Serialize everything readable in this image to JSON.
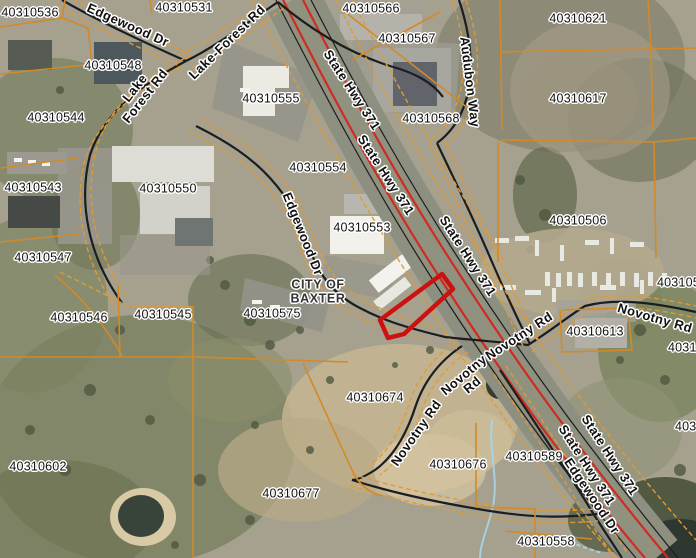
{
  "map": {
    "city_label": {
      "line1": "CITY OF",
      "line2": "BAXTER",
      "x": 318,
      "y": 292
    },
    "parcel_labels": [
      {
        "text": "40310536",
        "x": 30,
        "y": 13
      },
      {
        "text": "40310531",
        "x": 184,
        "y": 8
      },
      {
        "text": "40310566",
        "x": 371,
        "y": 9
      },
      {
        "text": "40310621",
        "x": 578,
        "y": 19
      },
      {
        "text": "40310567",
        "x": 407,
        "y": 39
      },
      {
        "text": "40310548",
        "x": 113,
        "y": 66
      },
      {
        "text": "40310617",
        "x": 578,
        "y": 99
      },
      {
        "text": "40310555",
        "x": 271,
        "y": 99
      },
      {
        "text": "40310544",
        "x": 56,
        "y": 118
      },
      {
        "text": "40310568",
        "x": 431,
        "y": 119
      },
      {
        "text": "40310554",
        "x": 318,
        "y": 168
      },
      {
        "text": "40310543",
        "x": 33,
        "y": 188
      },
      {
        "text": "40310550",
        "x": 168,
        "y": 189
      },
      {
        "text": "40310506",
        "x": 578,
        "y": 221
      },
      {
        "text": "40310553",
        "x": 362,
        "y": 228
      },
      {
        "text": "40310547",
        "x": 43,
        "y": 258
      },
      {
        "text": "40310575",
        "x": 272,
        "y": 314
      },
      {
        "text": "40310545",
        "x": 163,
        "y": 315
      },
      {
        "text": "40310546",
        "x": 79,
        "y": 318
      },
      {
        "text": "40310613",
        "x": 595,
        "y": 332
      },
      {
        "text": "40310674",
        "x": 375,
        "y": 398
      },
      {
        "text": "40310602",
        "x": 38,
        "y": 467
      },
      {
        "text": "40310589",
        "x": 534,
        "y": 457
      },
      {
        "text": "40310676",
        "x": 458,
        "y": 465
      },
      {
        "text": "40310677",
        "x": 291,
        "y": 494
      },
      {
        "text": "40310558",
        "x": 546,
        "y": 542
      }
    ],
    "clipped_labels": [
      {
        "text": "4031050",
        "x": 657,
        "y": 283
      },
      {
        "text": "40310",
        "x": 668,
        "y": 348
      },
      {
        "text": "4031",
        "x": 675,
        "y": 427
      }
    ],
    "road_labels": [
      {
        "text": "Edgewood Dr",
        "x": 128,
        "y": 25,
        "rot": 24
      },
      {
        "text": "Lake-Forest Rd",
        "x": 227,
        "y": 42,
        "rot": -44
      },
      {
        "lines": [
          "Lake",
          "Forest Rd"
        ],
        "x": 140,
        "y": 92,
        "rot": -52
      },
      {
        "text": "State Hwy 371",
        "x": 352,
        "y": 90,
        "rot": 57
      },
      {
        "text": "Audubon Way",
        "x": 470,
        "y": 82,
        "rot": 83
      },
      {
        "text": "State Hwy 371",
        "x": 386,
        "y": 175,
        "rot": 57
      },
      {
        "text": "Edgewood Dr",
        "x": 303,
        "y": 234,
        "rot": 68
      },
      {
        "text": "State Hwy 371",
        "x": 468,
        "y": 256,
        "rot": 57
      },
      {
        "text": "Novotny Rd",
        "x": 655,
        "y": 318,
        "rot": 16
      },
      {
        "text": "Novotny Rd",
        "x": 519,
        "y": 336,
        "rot": -33
      },
      {
        "lines": [
          "Novotny",
          "Rd"
        ],
        "x": 468,
        "y": 380,
        "rot": -40
      },
      {
        "text": "Novotny Rd",
        "x": 416,
        "y": 433,
        "rot": -55
      },
      {
        "text": "State Hwy 371",
        "x": 610,
        "y": 455,
        "rot": 57
      },
      {
        "text": "State Hwy 371",
        "x": 587,
        "y": 465,
        "rot": 57
      },
      {
        "text": "Edgewood Dr",
        "x": 592,
        "y": 496,
        "rot": 56
      }
    ],
    "colors": {
      "parcel_line": "#d28a28",
      "row_line": "#e09a35",
      "road": "#1d1d1d",
      "highway_red": "#cf2b24",
      "pavement": "#90927f",
      "label_text": "#111111",
      "label_halo": "#ffffff",
      "water_dark": "#38443a",
      "stream_blue": "#a5d6e8",
      "highlight": "#cc1111"
    }
  }
}
